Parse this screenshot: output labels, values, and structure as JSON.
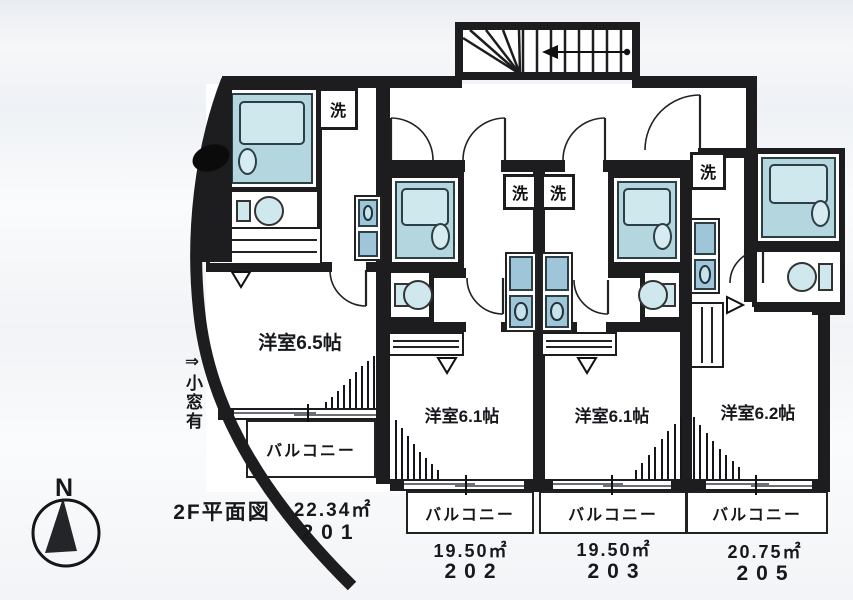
{
  "plan": {
    "floor_title": "2F平面図",
    "window_note": "⇒小窓有",
    "compass": {
      "north_label": "N"
    },
    "labels": {
      "balcony": "バルコニー",
      "laundry": "洗"
    },
    "units": [
      {
        "number": "201",
        "area": "22.34㎡",
        "room_label": "洋室6.5帖"
      },
      {
        "number": "202",
        "area": "19.50㎡",
        "room_label": "洋室6.1帖"
      },
      {
        "number": "203",
        "area": "19.50㎡",
        "room_label": "洋室6.1帖"
      },
      {
        "number": "205",
        "area": "20.75㎡",
        "room_label": "洋室6.2帖"
      }
    ]
  }
}
